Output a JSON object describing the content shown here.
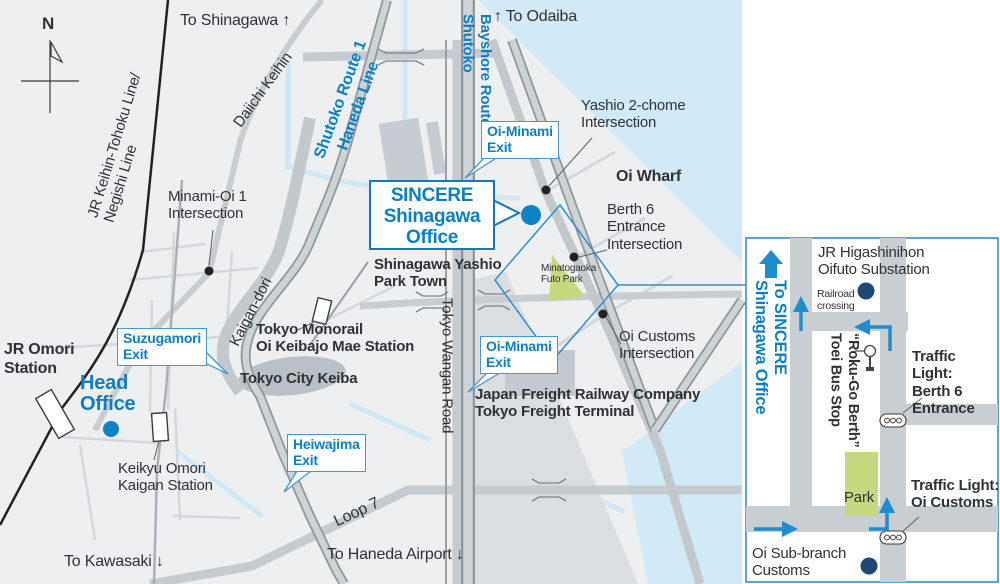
{
  "colors": {
    "accent": "#0d7fc0",
    "route_blue": "#1e8ccd",
    "water": "#d2eaf7",
    "road": "#c6cbd0",
    "expwy_casing": "#8f969c",
    "park_green": "#c6d97f",
    "navy": "#1c4a73",
    "panel_border": "#2e8fd0"
  },
  "m": {
    "compass": "N",
    "to_shinagawa": "To Shinagawa ↑",
    "to_odaiba": "↑ To Odaiba",
    "to_kawasaki": "To Kawasaki ↓",
    "to_haneda": "To Haneda Airport ↓",
    "jr_keihin": "JR Keihin-Tohoku Line/\nNegishi Line",
    "daiichi": "Daiichi Keihin",
    "route1": "Shutoko Route 1\nHaneda Line",
    "bayshore": "Shutoko\nBayshore Route",
    "kaigandori": "Kaigan-dori",
    "wangan": "Tokyo Wangan Road",
    "loop7": "Loop 7",
    "oi_minami_exit": "Oi-Minami\nExit",
    "suzugamori_exit": "Suzugamori\nExit",
    "heiwajima_exit": "Heiwajima\nExit",
    "sincere_office": "SINCERE\nShinagawa\nOffice",
    "head_office": "Head\nOffice",
    "jr_omori": "JR Omori\nStation",
    "keikyu": "Keikyu Omori\nKaigan Station",
    "monorail": "Tokyo Monorail\nOi Keibajo Mae Station",
    "city_keiba": "Tokyo City Keiba",
    "park_town": "Shinagawa Yashio\nPark Town",
    "futo_park": "Minatogaoka\nFuto Park",
    "oi_wharf": "Oi Wharf",
    "yashio": "Yashio 2-chome\nIntersection",
    "berth6": "Berth 6\nEntrance\nIntersection",
    "minami_oi": "Minami-Oi 1\nIntersection",
    "oi_customs": "Oi Customs\nIntersection",
    "freight": "Japan Freight Railway Company\nTokyo Freight Terminal"
  },
  "p": {
    "to_sincere": "To SINCERE\nShinagawa Office",
    "substation": "JR Higashinihon\nOifuto Substation",
    "railroad": "Railroad\ncrossing",
    "bus_stop": "Toei Bus Stop\n“Roku-Go Berth”",
    "tl_berth6": "Traffic Light:\nBerth 6\nEntrance",
    "tl_customs": "Traffic Light:\nOi Customs",
    "park": "Park",
    "customs_office": "Oi Sub-branch\nCustoms"
  }
}
